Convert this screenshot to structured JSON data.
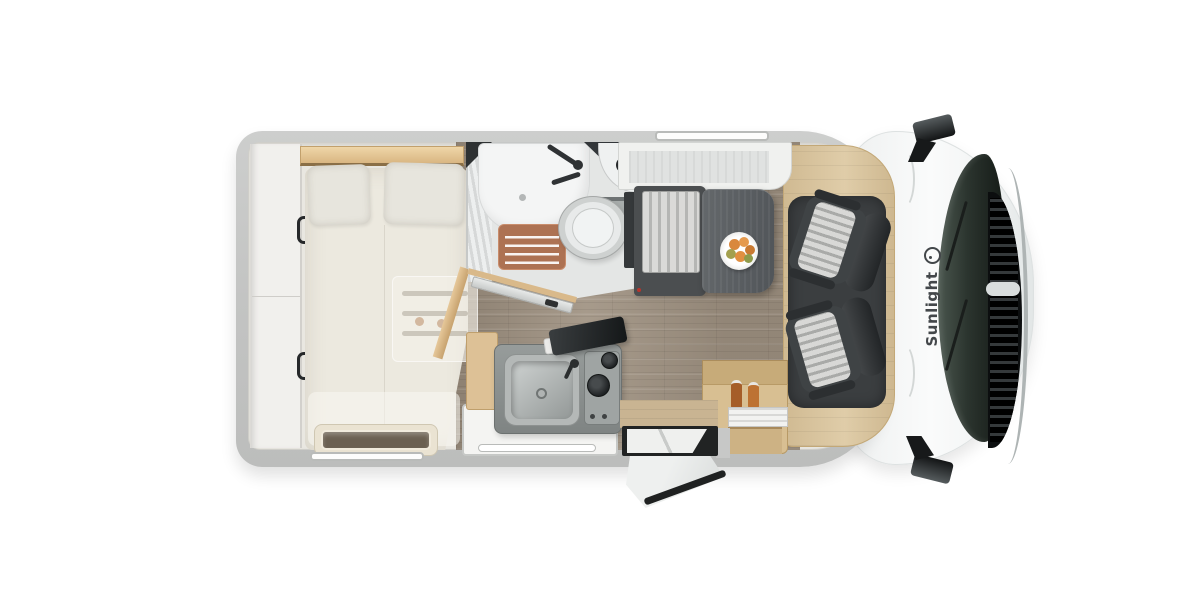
{
  "image_type": "motorhome-floor-plan-top-view",
  "brand": {
    "label": "Sunlight",
    "logo_icon": "sun-icon"
  },
  "palette": {
    "background": "#ffffff",
    "body_wall": "#c6c7c6",
    "interior_floor": "#e9e7e1",
    "plank_floor": "#a29585",
    "wood_trim": "#dcc79f",
    "cab_white": "#f7f8f8",
    "windshield_glass": "#2b342e",
    "grille_black": "#0c0e0f",
    "seat_dark": "#3f4345",
    "seat_stripe_light": "#d8d8d6",
    "table_gray": "#5d6164",
    "bench_dark": "#4b4e50",
    "shower_mat": "#ad7253",
    "mattress_cream": "#ece9df",
    "fruit_orange": "#e08f41"
  }
}
